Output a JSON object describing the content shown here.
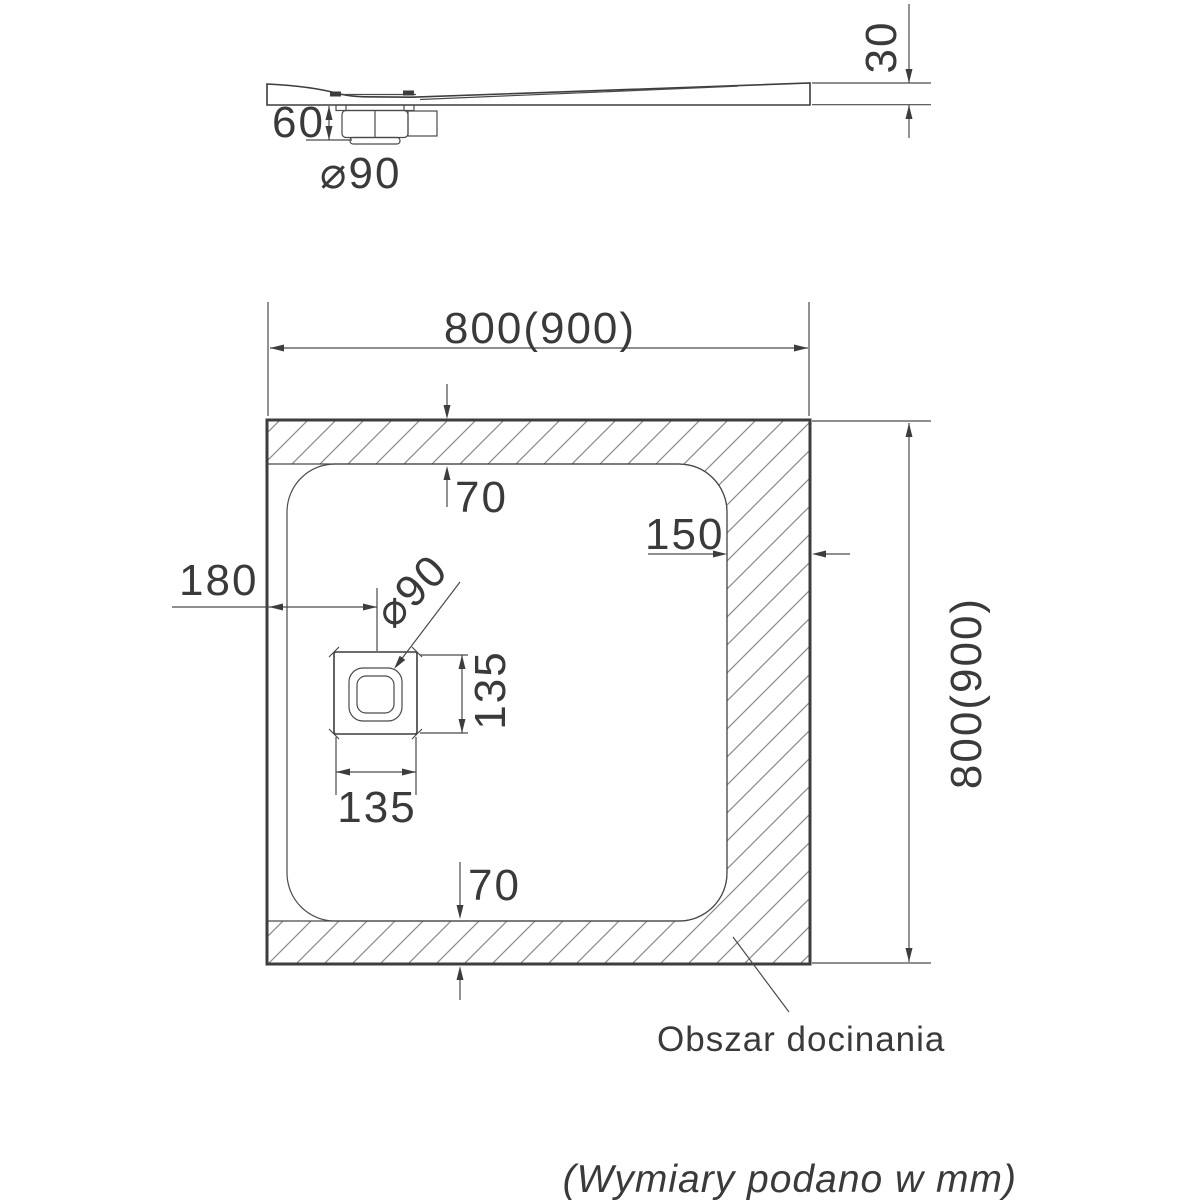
{
  "drawing": {
    "title_semantics": "shower tray technical drawing",
    "side_view": {
      "tray_thickness": "30",
      "trap_height": "60",
      "drain_diameter": "⌀90"
    },
    "plan_view": {
      "overall_width": "800(900)",
      "overall_height": "800(900)",
      "top_trim_offset": "70",
      "bottom_trim_offset": "70",
      "right_trim_offset": "150",
      "drain_center_offset": "180",
      "drain_width": "135",
      "drain_height": "135",
      "drain_diameter": "⌀90",
      "trim_area_label": "Obszar docinania"
    },
    "footer_note": "(Wymiary podano w mm)",
    "colors": {
      "line": "#3d3d3d",
      "dimension_line": "#4a4a4a",
      "hatch": "#8a8a8a",
      "text": "#3a3a3a",
      "background": "#ffffff"
    }
  }
}
